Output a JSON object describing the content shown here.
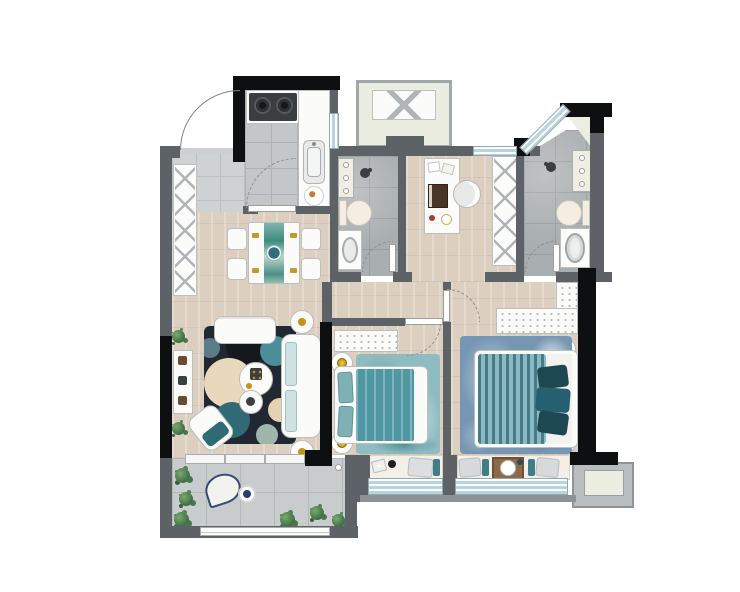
{
  "page": {
    "title": "Residential Apartment Floor Plan"
  },
  "colors": {
    "wall_gray": "#5d6266",
    "wall_black": "#0e0f11",
    "wood_floor": "#dccfbf",
    "kitchen_tile": "#c4c7c9",
    "bath_tile": "#a9aeb0",
    "balcony_tile": "#c9cccd",
    "window_blue": "#b7d4e0",
    "accent_teal": "#4f97a3",
    "accent_dark_teal": "#1d4852",
    "accent_gold": "#c9930f",
    "rug_navy": "#222831",
    "master_rug_blue": "#7796b3",
    "plant_green": "#3c6b42",
    "platform_beige": "#eaece0"
  },
  "rooms": [
    {
      "name": "Kitchen",
      "features": [
        "two-burner gas stove",
        "range hood",
        "sink",
        "L-shaped counter",
        "serving plate"
      ]
    },
    {
      "name": "Dining Area",
      "features": [
        "dining table for four",
        "teal table runner",
        "centerpiece bowl",
        "four chairs",
        "tall shoe cabinet"
      ]
    },
    {
      "name": "Living Room",
      "features": [
        "two-seat sofa",
        "three-seat sofa",
        "round side tables",
        "nested coffee tables",
        "circle-pattern rug",
        "accent armchair",
        "TV console",
        "potted plants"
      ]
    },
    {
      "name": "Entry",
      "features": [
        "entry door swing",
        "threshold"
      ]
    },
    {
      "name": "Bathroom",
      "features": [
        "toilet",
        "washbasin",
        "shower head",
        "storage shelf"
      ]
    },
    {
      "name": "Vanity Corridor",
      "features": [
        "dressing table",
        "mirror",
        "stool",
        "tall linen cabinet"
      ]
    },
    {
      "name": "Master Bathroom",
      "features": [
        "toilet",
        "laundry basin",
        "shower head",
        "storage shelf",
        "corner window"
      ]
    },
    {
      "name": "Second Bedroom",
      "features": [
        "double bed with teal bedding",
        "nightstand lamps",
        "dotted dresser",
        "teal rug",
        "bay window seat with pillows and book"
      ]
    },
    {
      "name": "Master Bedroom",
      "features": [
        "queen bed with draped teal duvet",
        "nightstand lamps",
        "dresser",
        "wardrobe",
        "blue marble rug",
        "bay window seat with tray and pillows"
      ]
    },
    {
      "name": "Balcony",
      "features": [
        "lounge chair",
        "round side table",
        "potted plants",
        "railing"
      ]
    },
    {
      "name": "Equipment Platform",
      "features": [
        "crossed-box pad"
      ]
    },
    {
      "name": "AC Platform",
      "features": [
        "outdoor unit pad"
      ]
    }
  ]
}
